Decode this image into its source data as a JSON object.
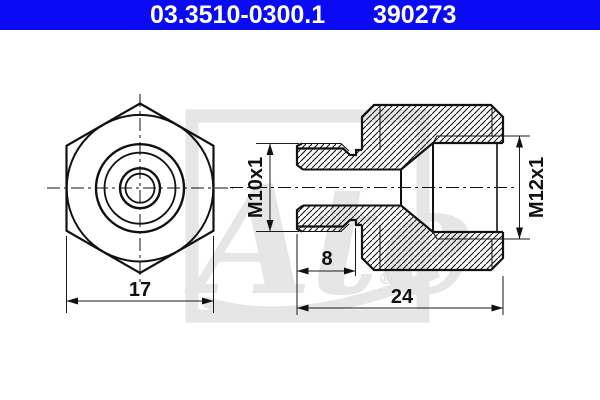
{
  "header": {
    "part_number": "03.3510-0300.1",
    "ref_number": "390273",
    "bar_color": "#0a0af5",
    "text_color": "#ffffff"
  },
  "dimensions": {
    "front_width": "17",
    "male_thread": "M10x1",
    "female_thread": "M12x1",
    "thread_length": "8",
    "total_length": "24"
  },
  "watermark": {
    "logo_text": "Ate",
    "registered": "®"
  },
  "colors": {
    "line": "#111111",
    "watermark": "#e6e6e6",
    "background": "#ffffff"
  }
}
